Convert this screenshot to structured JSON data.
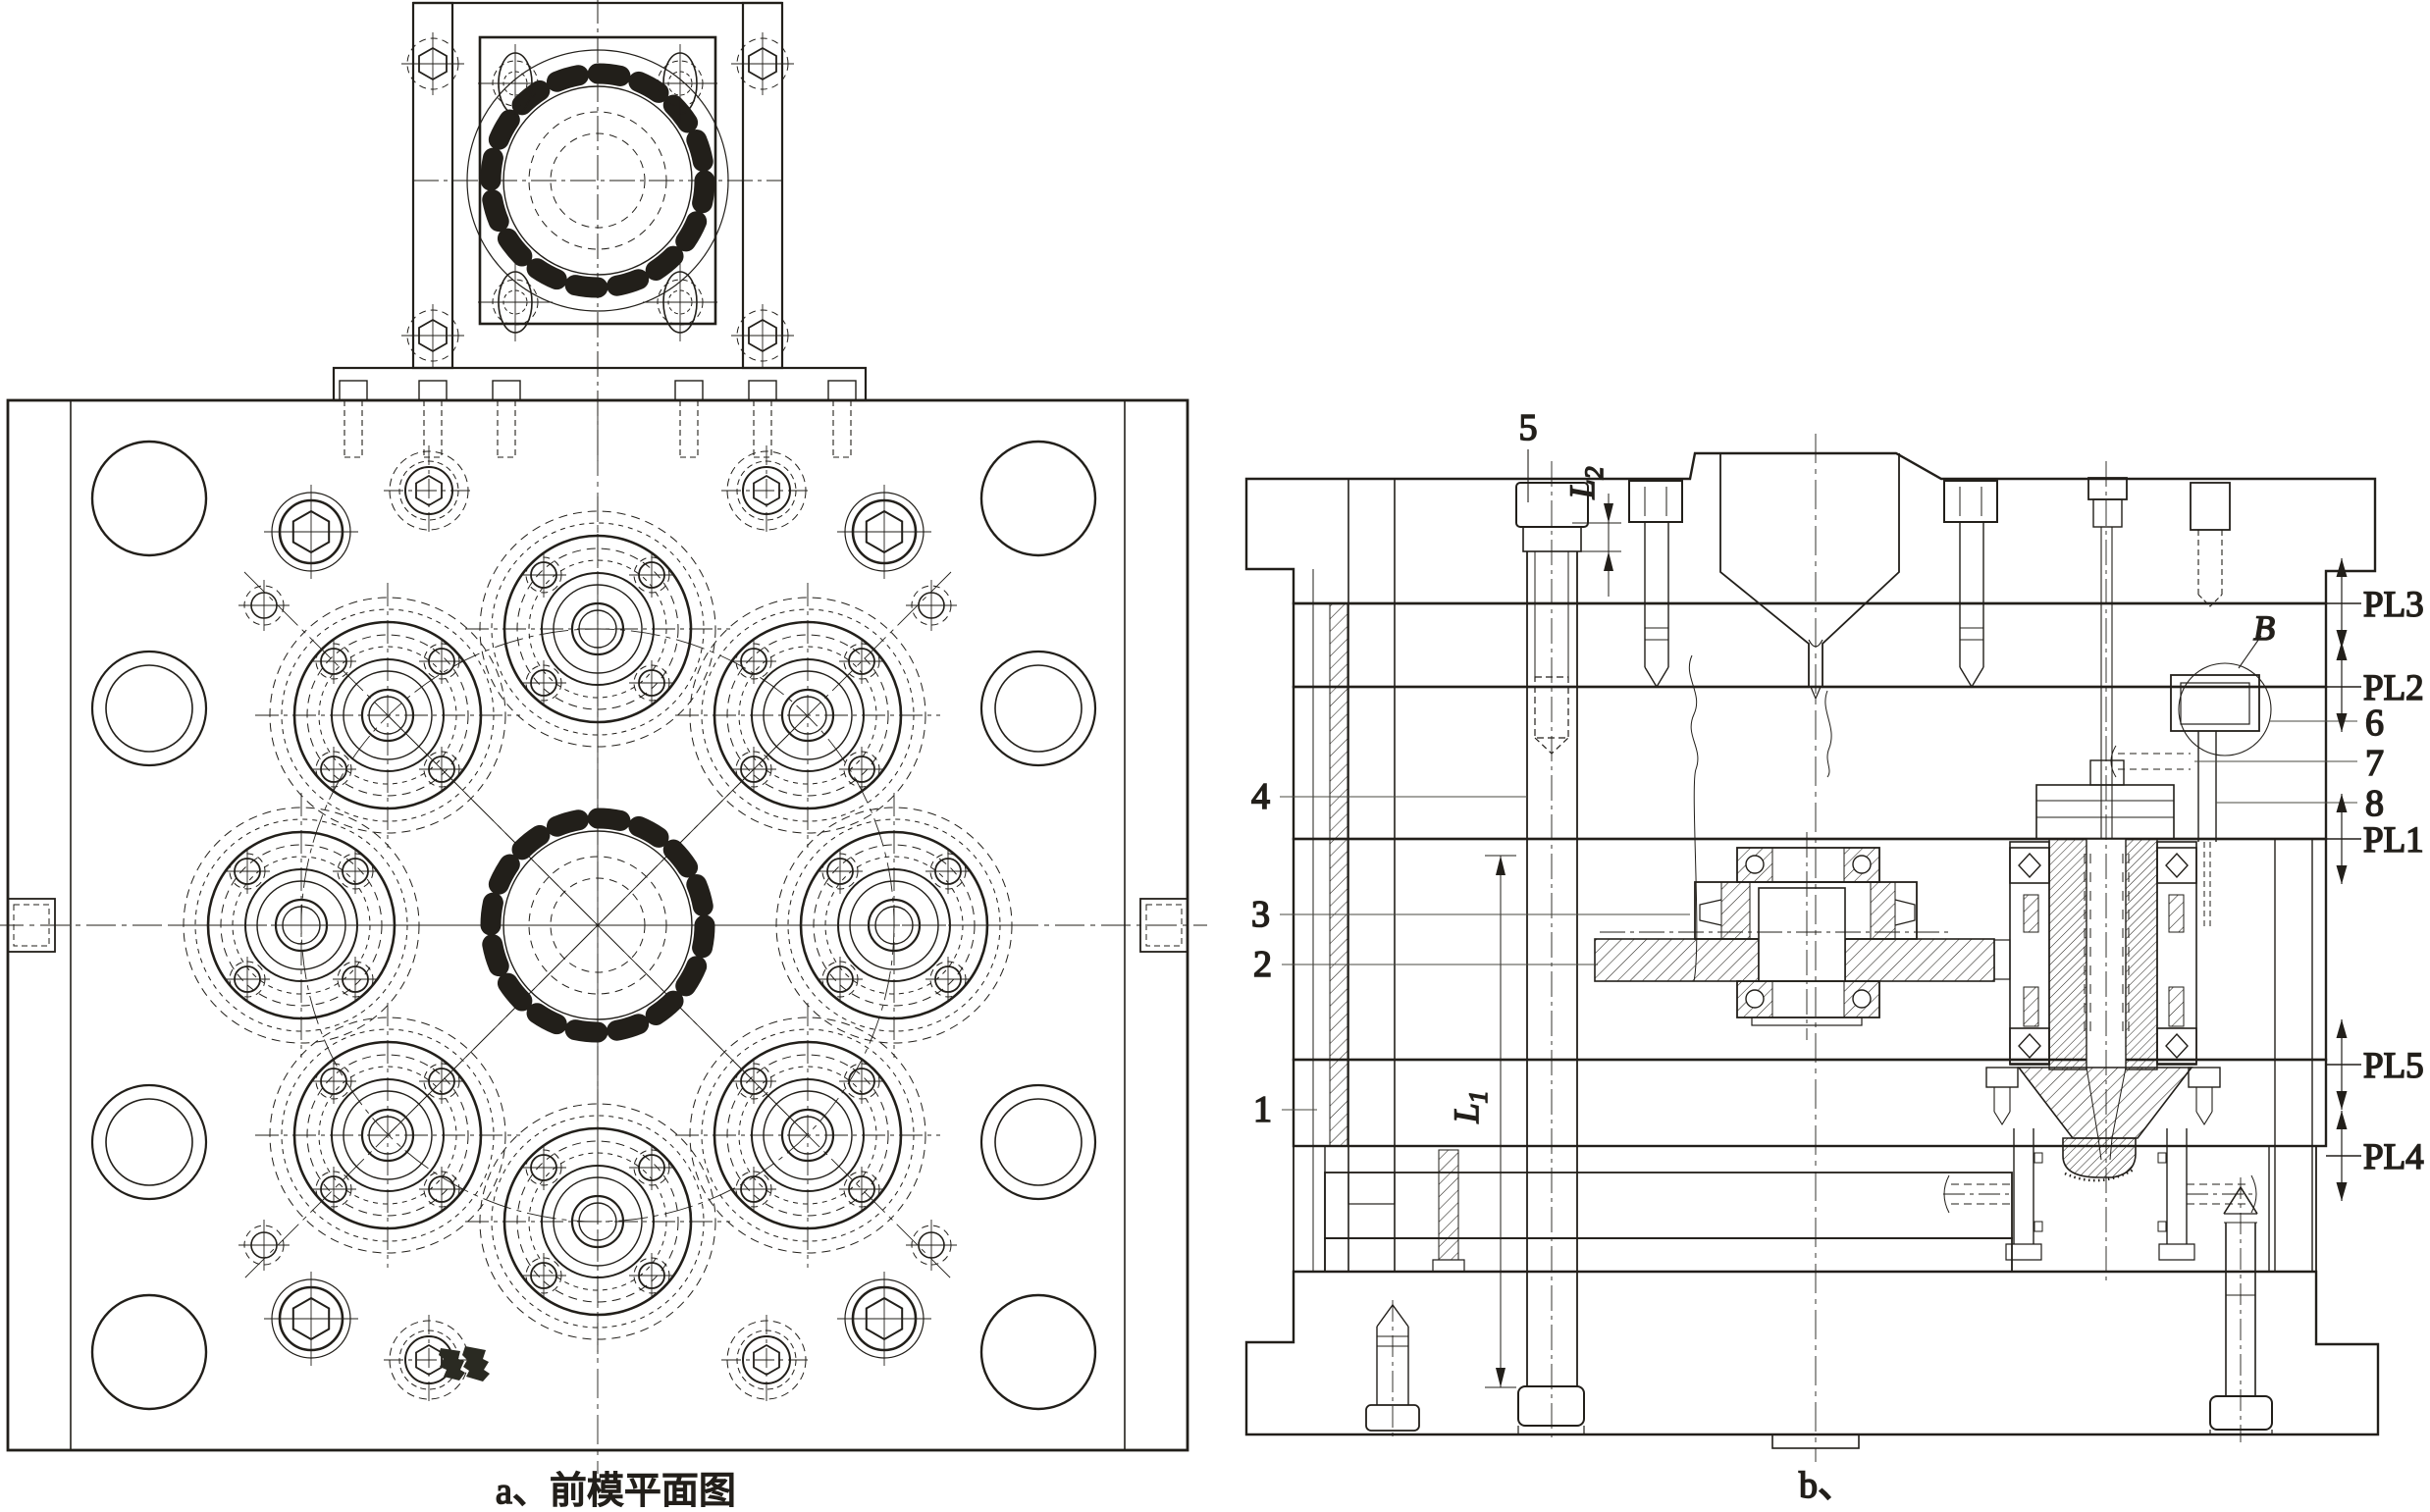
{
  "drawing": {
    "captions": {
      "plan": "a、前模平面图",
      "section": "b、"
    },
    "part_labels": {
      "n1": "1",
      "n2": "2",
      "n3": "3",
      "n4": "4",
      "n5": "5",
      "n6": "6",
      "n7": "7",
      "n8": "8"
    },
    "parting_line_labels": {
      "pl1": "PL1",
      "pl2": "PL2",
      "pl3": "PL3",
      "pl4": "PL4",
      "pl5": "PL5"
    },
    "detail_label": "B",
    "dimensions": {
      "l1": {
        "base": "L",
        "sub": "1"
      },
      "l2": {
        "base": "L",
        "sub": "2"
      }
    },
    "colors": {
      "ink": "#221f1a",
      "paper": "#ffffff",
      "leader": "#4a4a42"
    }
  }
}
